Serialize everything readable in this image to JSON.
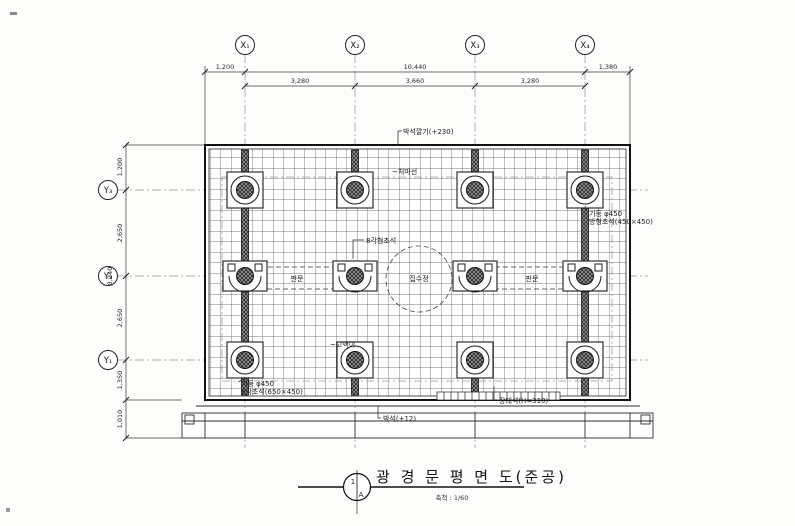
{
  "grid": {
    "x_labels": [
      "X₁",
      "X₂",
      "X₃",
      "X₄"
    ],
    "y_labels": [
      "Y₃",
      "Y₂",
      "Y₁"
    ]
  },
  "dimensions": {
    "top": {
      "left_offset": "1,200",
      "overall": "10,440",
      "right_offset": "1,380",
      "span_1": "3,280",
      "span_2": "3,660",
      "span_3": "3,280"
    },
    "left": {
      "top_offset": "1,200",
      "span_1": "2,650",
      "span_2": "2,650",
      "overall": "8,240",
      "bottom_offset": "1,350",
      "step": "1,010"
    }
  },
  "annotations": {
    "paving_top": "박석깔기(+230)",
    "eaves": "~처마선",
    "octagonal_base": "8각형초석",
    "col_right_line1": "기둥 φ450",
    "col_right_line2": "방형초석(450×450)",
    "door_left": "판문",
    "door_right": "판문",
    "center_circle": "집수정",
    "gomaegi": "~고맥이",
    "col_bl_line1": "기둥 φ450",
    "col_bl_line2": "8각초석(650×450)",
    "step_stone": "장대석(H=310)",
    "paving_bottom": "박석(+12)"
  },
  "titleblock": {
    "title": "광 경 문 평 면 도(준공)",
    "scale": "축척 : 1/60",
    "marker_top": "1",
    "marker_bottom": "A"
  }
}
